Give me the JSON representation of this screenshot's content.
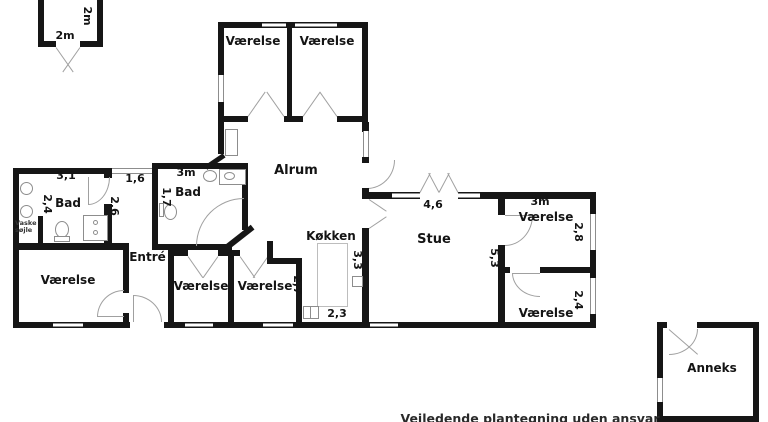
{
  "plan": {
    "footer": "Vejledende plantegning uden ansvar",
    "shed": {
      "w": "2m",
      "d": "2m"
    },
    "top_rooms": {
      "left": "Værelse",
      "right": "Værelse"
    },
    "alrum": {
      "name": "Alrum"
    },
    "bad_left": {
      "name": "Bad",
      "w": "3,1",
      "d": "2,4"
    },
    "laundry": {
      "l1": "Vaske",
      "l2": "søjle"
    },
    "hall": {
      "w": "1,6",
      "l": "2,6"
    },
    "bad_right": {
      "name": "Bad",
      "w": "3m",
      "d": "1,7"
    },
    "entre": {
      "name": "Entré"
    },
    "bedroom_sw": {
      "name": "Værelse"
    },
    "bedroom_s1": {
      "name": "Værelse"
    },
    "bedroom_s2": {
      "name": "Værelse",
      "w": "2,7"
    },
    "kitchen": {
      "name": "Køkken",
      "d_right": "3,3",
      "d_bottom": "2,3"
    },
    "stue": {
      "name": "Stue",
      "door_w": "4,6",
      "d": "5,3"
    },
    "bedroom_e1": {
      "name": "Værelse",
      "w": "3m",
      "d": "2,8"
    },
    "bedroom_e2": {
      "name": "Værelse",
      "d": "2,4"
    },
    "anneks": {
      "name": "Anneks"
    }
  }
}
